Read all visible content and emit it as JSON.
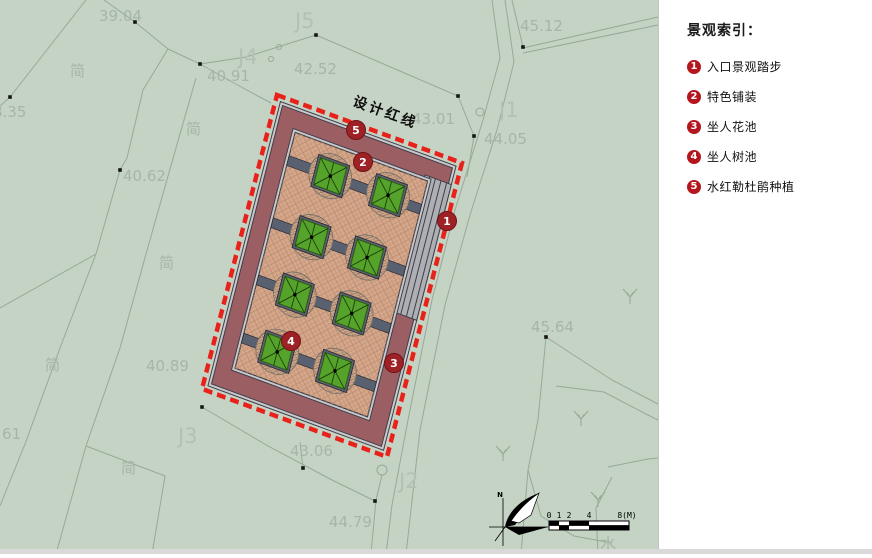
{
  "panel": {
    "title": "景观索引：",
    "items": [
      {
        "num": "1",
        "label": "入口景观踏步"
      },
      {
        "num": "2",
        "label": "特色铺装"
      },
      {
        "num": "3",
        "label": "坐人花池"
      },
      {
        "num": "4",
        "label": "坐人树池"
      },
      {
        "num": "5",
        "label": "水红勒杜鹃种植"
      }
    ]
  },
  "map": {
    "red_line_label": "设计红线",
    "north_label": "N",
    "water_label": "水",
    "scale_ticks": [
      {
        "t": "0",
        "x": 0
      },
      {
        "t": "1",
        "x": 10
      },
      {
        "t": "2",
        "x": 20
      },
      {
        "t": "4",
        "x": 40
      },
      {
        "t": "8(M)",
        "x": 78
      }
    ],
    "survey_labels": [
      {
        "t": "39.04",
        "x": 99,
        "y": 21,
        "k": "num"
      },
      {
        "t": "J5",
        "x": 295,
        "y": 28,
        "k": "J"
      },
      {
        "t": "J4",
        "x": 238,
        "y": 64,
        "k": "J"
      },
      {
        "t": "42.52",
        "x": 294,
        "y": 74,
        "k": "num"
      },
      {
        "t": "40.91",
        "x": 207,
        "y": 81,
        "k": "num"
      },
      {
        "t": "45.12",
        "x": 520,
        "y": 31,
        "k": "num"
      },
      {
        "t": "J1",
        "x": 499,
        "y": 117,
        "k": "J"
      },
      {
        "t": "43.01",
        "x": 412,
        "y": 124,
        "k": "num"
      },
      {
        "t": "44.05",
        "x": 484,
        "y": 144,
        "k": "num"
      },
      {
        "t": "8.35",
        "x": -7,
        "y": 117,
        "k": "num"
      },
      {
        "t": "40.62",
        "x": 123,
        "y": 181,
        "k": "num"
      },
      {
        "t": "简",
        "x": 70,
        "y": 76,
        "k": "cn"
      },
      {
        "t": "简",
        "x": 186,
        "y": 134,
        "k": "cn"
      },
      {
        "t": "简",
        "x": 159,
        "y": 268,
        "k": "cn"
      },
      {
        "t": "简",
        "x": 45,
        "y": 370,
        "k": "cn"
      },
      {
        "t": "简",
        "x": 121,
        "y": 473,
        "k": "cn"
      },
      {
        "t": "40.89",
        "x": 146,
        "y": 371,
        "k": "num"
      },
      {
        "t": "61",
        "x": 2,
        "y": 439,
        "k": "num"
      },
      {
        "t": "J3",
        "x": 178,
        "y": 443,
        "k": "J"
      },
      {
        "t": "43.06",
        "x": 290,
        "y": 456,
        "k": "num"
      },
      {
        "t": "J2",
        "x": 399,
        "y": 488,
        "k": "J"
      },
      {
        "t": "44.79",
        "x": 329,
        "y": 527,
        "k": "num"
      },
      {
        "t": "45.64",
        "x": 531,
        "y": 332,
        "k": "num"
      }
    ],
    "markers": [
      {
        "num": "5",
        "x": 356,
        "y": 130
      },
      {
        "num": "2",
        "x": 363,
        "y": 162
      },
      {
        "num": "1",
        "x": 447,
        "y": 221
      },
      {
        "num": "4",
        "x": 291,
        "y": 341
      },
      {
        "num": "3",
        "x": 394,
        "y": 363
      }
    ],
    "dots": [
      [
        10,
        97
      ],
      [
        135,
        22
      ],
      [
        200,
        64
      ],
      [
        316,
        35
      ],
      [
        458,
        96
      ],
      [
        474,
        136
      ],
      [
        523,
        47
      ],
      [
        120,
        170
      ],
      [
        546,
        337
      ],
      [
        303,
        468
      ],
      [
        375,
        501
      ],
      [
        202,
        407
      ]
    ],
    "rings": [
      [
        279,
        47,
        2.5
      ],
      [
        271,
        59,
        2.5
      ],
      [
        382,
        470,
        5
      ],
      [
        480,
        112,
        4
      ]
    ],
    "grass": [
      [
        630,
        295
      ],
      [
        581,
        417
      ],
      [
        503,
        452
      ],
      [
        598,
        498
      ]
    ],
    "lines": [
      "86,0 10,97",
      "10,97 0,106",
      "104,0 135,22 168,49",
      "168,49 200,64",
      "200,64 246,57 316,35",
      "316,35 458,96 474,136 467,177",
      "200,64 243,88 271,103",
      "168,49 143,90 127,158 120,170 96,254 60,348 25,444 0,506",
      "196,78 172,162 146,254 120,348 86,446 56,554",
      "86,446 165,476 152,554",
      "492,0 500,58 483,120 455,210 432,300 408,420 392,505 386,554",
      "505,0 514,62 497,130 470,215 445,305 420,430 406,554",
      "546,337 538,420 528,470 521,554",
      "546,337 612,380 658,404",
      "556,386 604,392 646,414 658,420",
      "528,470 541,516 574,536 612,543",
      "612,477 596,508 598,554",
      "608,467 648,459 658,458",
      "202,407 268,446 332,480 375,501",
      "303,468 300,442",
      "382,475 376,500 371,554",
      "523,48 658,17",
      "523,53 658,25",
      "523,47 512,0",
      "0,308 96,254"
    ]
  },
  "colors": {
    "bg": "#c4d3c4",
    "panel": "#ffffff",
    "redline": "#e8211a",
    "maroon": "#9b5e62",
    "floor": "#d5a88b",
    "floorline": "#bf8e72",
    "band": "#59606f",
    "tree": "#55a32a",
    "marker": "#9e2126",
    "legendred": "#b5161d",
    "lineclr": "#98a998",
    "labelclr": "#a6b5a6",
    "jclr": "#b2c1b2"
  }
}
